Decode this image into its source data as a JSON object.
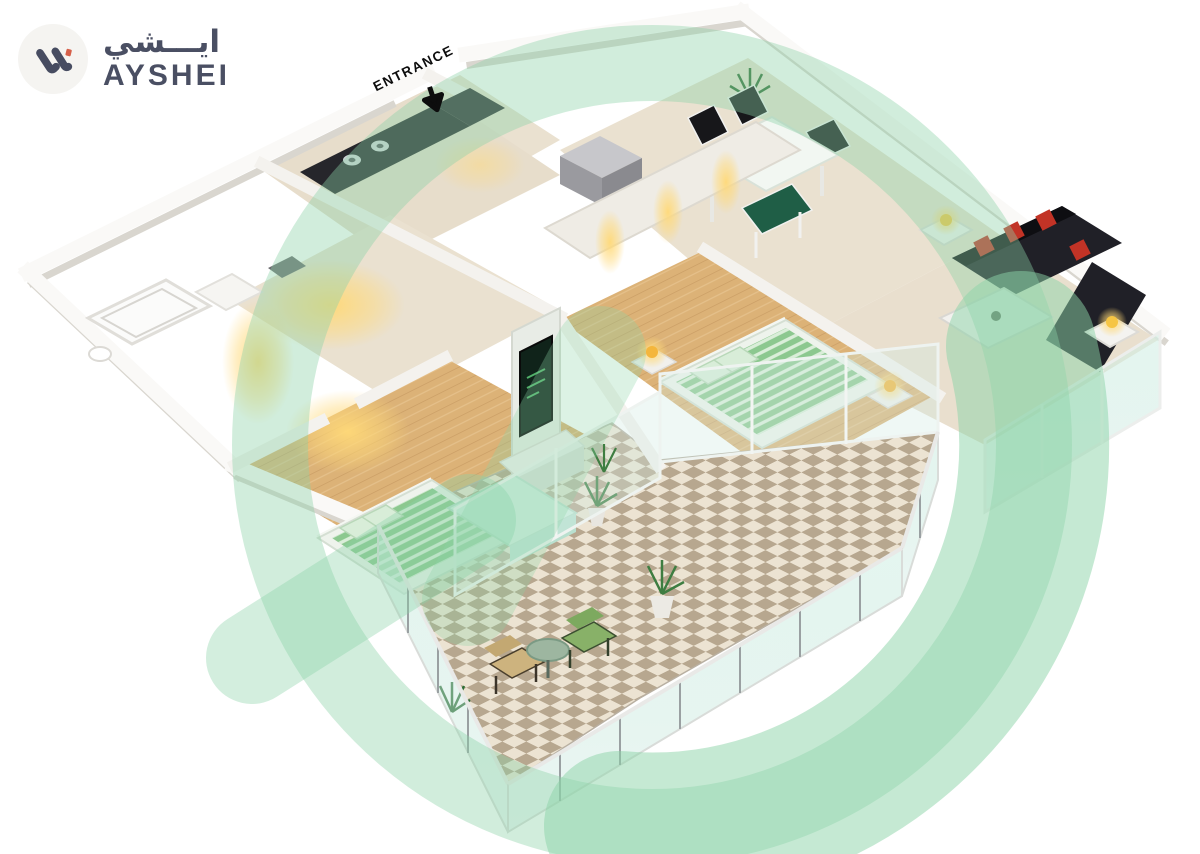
{
  "branding": {
    "logo_arabic": "ايـــشي",
    "logo_latin": "AYSHEI",
    "mark_color": "#474c61",
    "mark_accent": "#d6604a",
    "badge_background": "#f5f4f1"
  },
  "entrance": {
    "label": "ENTRANCE"
  },
  "watermark": {
    "shape": "ring-and-swoosh",
    "color": "#8bd3a7"
  },
  "palette": {
    "background": "#ffffff",
    "wall_white": "#faf9f7",
    "wall_shadow": "#d9d6cf",
    "floor_beige": "#eae1d0",
    "floor_wood": "#dcb277",
    "bed_green": "#8cc88f",
    "bed_frame_white": "#eef3ec",
    "pillow_green": "#d8edd8",
    "bench_mint": "#cdeedd",
    "sofa_black": "#202027",
    "cushion_red": "#c23326",
    "chair_black": "#17171a",
    "chair_green_dark": "#1f5e46",
    "lamp_yellow": "#f6c544",
    "glow_warm": "#ffd978",
    "glass_green": "#cfe9df",
    "tile_light": "#ece3d2",
    "tile_dark": "#b7a78f",
    "counter_black": "#26262b",
    "plant_green": "#3e7d41",
    "tv_screen_green": "#52b06a"
  },
  "scene": {
    "type": "isometric-3d-floor-plan",
    "areas": [
      "kitchen",
      "bathroom",
      "hallway",
      "dining-area",
      "living-room",
      "master-bedroom",
      "second-bedroom",
      "balcony"
    ],
    "furniture": [
      "kitchen-counter",
      "stove",
      "appliance-box",
      "dining-table",
      "dining-chairs",
      "indoor-plants",
      "sofa",
      "red-cushions",
      "side-tables",
      "table-lamps",
      "coffee-table",
      "wardrobe-downlights",
      "master-bed",
      "nightstands",
      "tv-console",
      "tv",
      "second-bed",
      "bench-daybed",
      "balcony-chairs",
      "balcony-round-table",
      "glass-railing",
      "checkered-tiles"
    ]
  }
}
